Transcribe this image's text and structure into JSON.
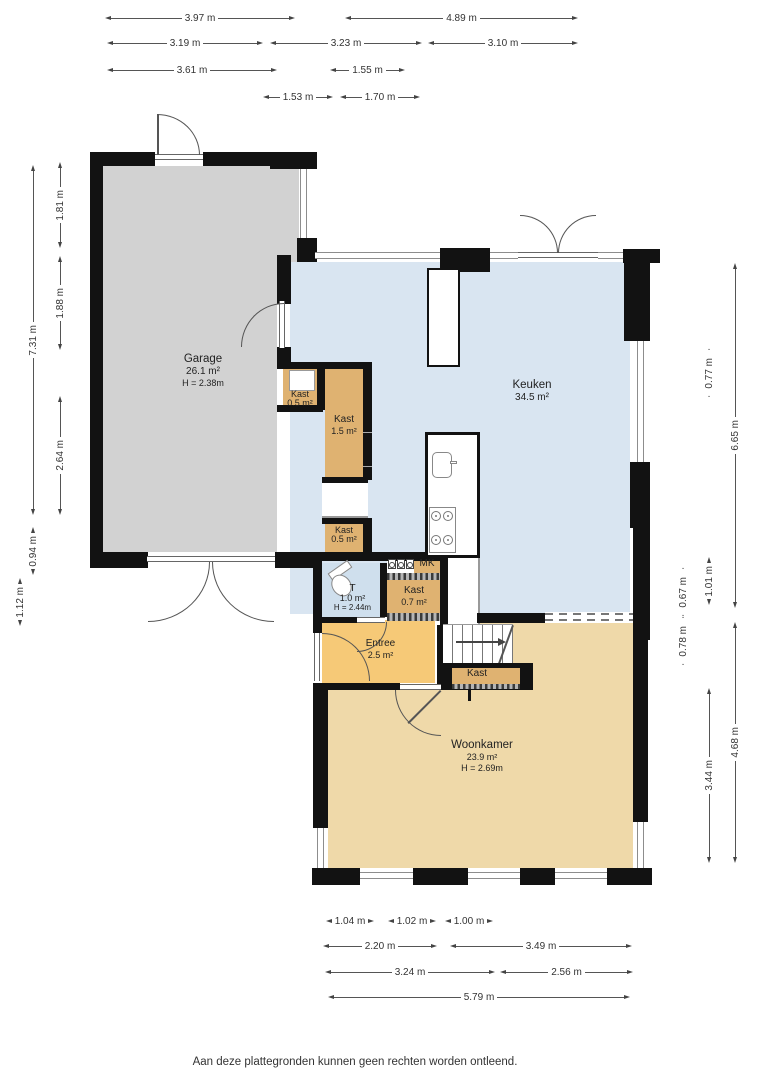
{
  "rooms": {
    "garage": {
      "name": "Garage",
      "area": "26.1 m²",
      "height": "H = 2.38m"
    },
    "keuken": {
      "name": "Keuken",
      "area": "34.5 m²"
    },
    "woonkamer": {
      "name": "Woonkamer",
      "area": "23.9 m²",
      "height": "H = 2.69m"
    },
    "entree": {
      "name": "Entree",
      "area": "2.5 m²"
    },
    "toilet": {
      "name": "T",
      "area": "1.0 m²",
      "height": "H = 2.44m"
    },
    "kast_boven": {
      "name": "Kast",
      "area": "0.5 m²"
    },
    "kast_groot": {
      "name": "Kast",
      "area": "1.5 m²"
    },
    "kast_klein": {
      "name": "Kast",
      "area": "0.5 m²"
    },
    "kast_hal": {
      "name": "Kast",
      "area": "0.7 m²"
    },
    "kast_trap": {
      "name": "Kast"
    },
    "meterkast": {
      "name": "MK"
    }
  },
  "dimensions": {
    "top": [
      {
        "label": "3.97 m"
      },
      {
        "label": "4.89 m"
      },
      {
        "label": "3.19 m"
      },
      {
        "label": "3.23 m"
      },
      {
        "label": "3.10 m"
      },
      {
        "label": "3.61 m"
      },
      {
        "label": "1.55 m"
      },
      {
        "label": "1.53 m"
      },
      {
        "label": "1.70 m"
      }
    ],
    "left": [
      {
        "label": "7.31 m"
      },
      {
        "label": "1.81 m"
      },
      {
        "label": "1.88 m"
      },
      {
        "label": "2.64 m"
      },
      {
        "label": "0.94 m"
      },
      {
        "label": "1.12 m"
      }
    ],
    "right": [
      {
        "label": "6.65 m"
      },
      {
        "label": "0.77 m"
      },
      {
        "label": "1.01 m"
      },
      {
        "label": "0.67 m"
      },
      {
        "label": "0.78 m"
      },
      {
        "label": "4.68 m"
      },
      {
        "label": "3.44 m"
      }
    ],
    "bottom": [
      {
        "label": "1.04 m"
      },
      {
        "label": "1.02 m"
      },
      {
        "label": "1.00 m"
      },
      {
        "label": "2.20 m"
      },
      {
        "label": "3.49 m"
      },
      {
        "label": "3.24 m"
      },
      {
        "label": "2.56 m"
      },
      {
        "label": "5.79 m"
      }
    ]
  },
  "colors": {
    "wall": "#121212",
    "garage_floor": "#d2d2d2",
    "keuken_floor": "#d9e5f1",
    "woonkamer_floor": "#efd9a9",
    "entree_floor": "#f6c977",
    "kast_floor": "#dfb271",
    "toilet_floor": "#cfdfed",
    "window_line": "#8d8d8d"
  },
  "footer": {
    "disclaimer": "Aan deze plattegronden kunnen geen rechten worden ontleend."
  }
}
